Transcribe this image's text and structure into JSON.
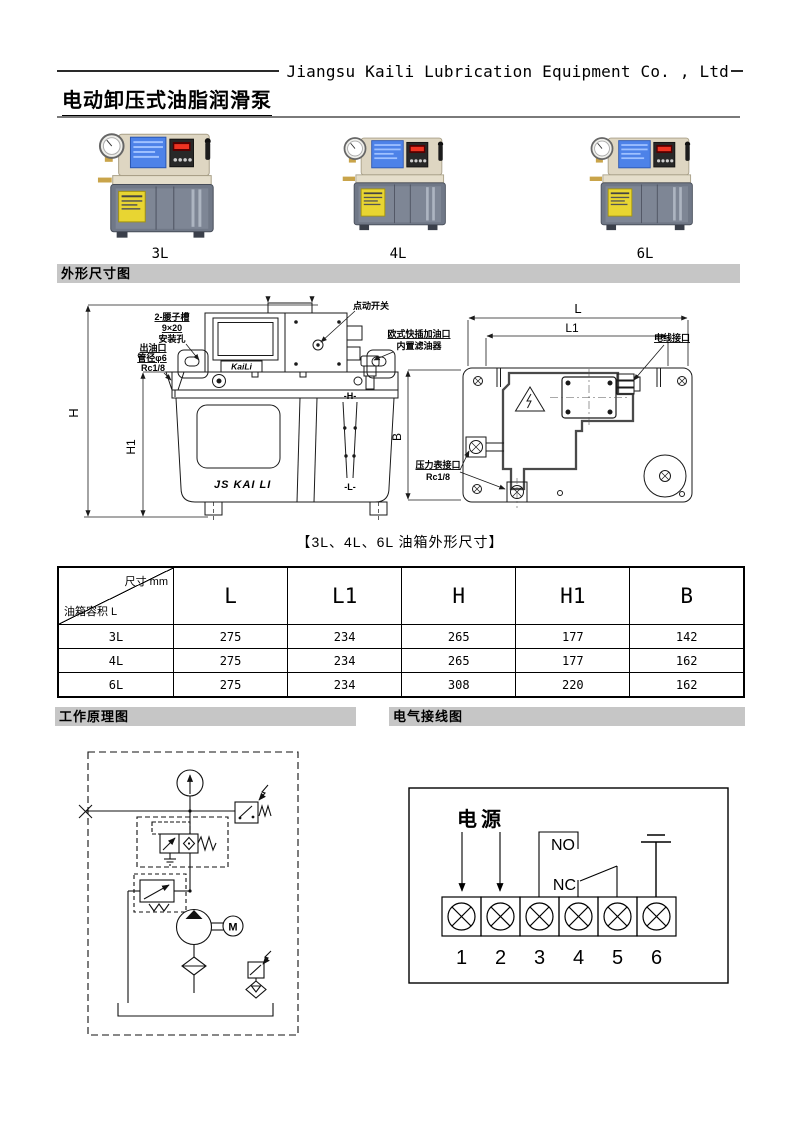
{
  "header": {
    "company": "Jiangsu Kaili Lubrication Equipment Co. , Ltd"
  },
  "title": "电动卸压式油脂润滑泵",
  "products": {
    "labels": [
      "3L",
      "4L",
      "6L"
    ]
  },
  "sections": {
    "outline": "外形尺寸图",
    "principle": "工作原理图",
    "wiring": "电气接线图"
  },
  "outline_drawing": {
    "caption": "【3L、4L、6L 油箱外形尺寸】",
    "front_view": {
      "slot_label_1": "2-腰子槽",
      "slot_label_2": "9×20",
      "slot_label_3": "安装孔",
      "outlet_label_1": "出油口",
      "outlet_label_2": "管径φ6",
      "outlet_label_3": "Rc1/8",
      "jog_switch_label": "点动开关",
      "fill_port_label_1": "欧式快插加油口",
      "fill_port_label_2": "内置滤油器",
      "brand_plate": "KaiLi",
      "tank_brand": "JS KAI LI",
      "level_high": "-H-",
      "level_low": "-L-",
      "dim_h": "H",
      "dim_h1": "H1"
    },
    "top_view": {
      "dim_l": "L",
      "dim_l1": "L1",
      "dim_b": "B",
      "wire_port_label": "电线接口",
      "gauge_port_label_1": "压力表接口",
      "gauge_port_label_2": "Rc1/8"
    }
  },
  "dimension_table": {
    "corner_top": "尺寸 mm",
    "corner_bottom": "油箱容积 L",
    "columns": [
      "L",
      "L1",
      "H",
      "H1",
      "B"
    ],
    "rows": [
      {
        "model": "3L",
        "values": [
          "275",
          "234",
          "265",
          "177",
          "142"
        ]
      },
      {
        "model": "4L",
        "values": [
          "275",
          "234",
          "265",
          "177",
          "162"
        ]
      },
      {
        "model": "6L",
        "values": [
          "275",
          "234",
          "308",
          "220",
          "162"
        ]
      }
    ]
  },
  "principle_diagram": {
    "motor_label": "M"
  },
  "wiring_diagram": {
    "power_label": "电源",
    "no_label": "NO",
    "nc_label": "NC",
    "terminals": [
      "1",
      "2",
      "3",
      "4",
      "5",
      "6"
    ]
  },
  "colors": {
    "banner_bg": "#c6c6c6",
    "housing_beige": "#ded6c2",
    "tank_gray": "#707887",
    "lcd_blue": "#4d82e8",
    "display_red": "#ee3322",
    "label_yellow": "#e8d532"
  }
}
